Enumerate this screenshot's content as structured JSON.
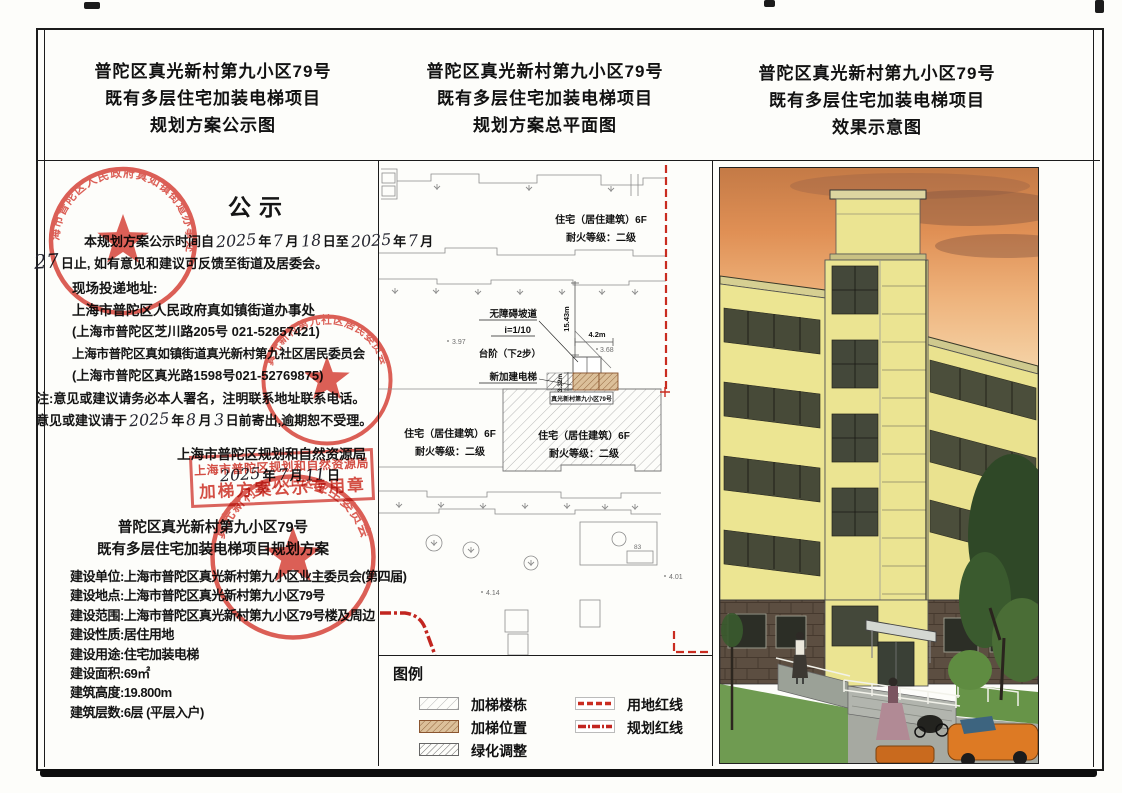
{
  "titles": {
    "left_line1": "普陀区真光新村第九小区79号",
    "left_line2": "既有多层住宅加装电梯项目",
    "left_line3": "规划方案公示图",
    "mid_line1": "普陀区真光新村第九小区79号",
    "mid_line2": "既有多层住宅加装电梯项目",
    "mid_line3": "规划方案总平面图",
    "right_line1": "普陀区真光新村第九小区79号",
    "right_line2": "既有多层住宅加装电梯项目",
    "right_line3": "效果示意图"
  },
  "notice": {
    "heading": "公示",
    "p1_a": "本规划方案公示时间自",
    "p1_y1": "2025",
    "p1_t1": "年",
    "p1_m1": "7",
    "p1_t2": "月",
    "p1_d1": "18",
    "p1_t3": "日至",
    "p1_y2": "2025",
    "p1_t4": "年",
    "p1_m2": "7",
    "p1_t5": "月",
    "p1_d2": "27",
    "p1_b": "日止, 如有意见和建议可反馈至街道及居委会。",
    "addr_label": "现场投递地址:",
    "addr1": "上海市普陀区人民政府真如镇街道办事处",
    "addr1_detail": "(上海市普陀区芝川路205号 021-52857421)",
    "addr2": "上海市普陀区真如镇街道真光新村第九社区居民委员会",
    "addr2_detail": "(上海市普陀区真光路1598号021-52769875)",
    "note1": "注:意见或建议请务必本人署名，注明联系地址联系电话。",
    "note2_a": "意见或建议请于",
    "note2_y": "2025",
    "note2_t1": "年",
    "note2_m": "8",
    "note2_t2": "月",
    "note2_d": "3",
    "note2_b": "日前寄出,逾期恕不受理。"
  },
  "authority": {
    "name": "上海市普陀区规划和自然资源局",
    "date_y": "2025",
    "date_t1": "年",
    "date_m": "7",
    "date_t2": "月",
    "date_d": "11",
    "date_t3": "日",
    "stamp_line1": "上海市普陀区规划和自然资源局",
    "stamp_line2": "加梯方案公示专用章"
  },
  "project": {
    "name1": "普陀区真光新村第九小区79号",
    "name2": "既有多层住宅加装电梯项目规划方案",
    "details": [
      "建设单位:上海市普陀区真光新村第九小区业主委员会(第四届)",
      "建设地点:上海市普陀区真光新村第九小区79号",
      "建设范围:上海市普陀区真光新村第九小区79号楼及周边",
      "建设性质:居住用地",
      "建设用途:住宅加装电梯",
      "建设面积:69㎡",
      "建筑高度:19.800m",
      "建筑层数:6层 (平层入户)"
    ]
  },
  "stamps": {
    "street_office": "上海市普陀区人民政府真如镇街道办事处",
    "community": "真光新村第九社区居民委员会",
    "owners": "真光新村第九小区业主委员会"
  },
  "siteplan": {
    "bldg_line1": "住宅（居住建筑）6F",
    "bldg_line2": "耐火等级：二级",
    "callout_ramp": "无障碍坡道",
    "callout_ramp2": "i=1/10",
    "callout_steps": "台阶（下2步）",
    "callout_elevator": "新加建电梯",
    "dim_1543": "15.43m",
    "dim_42": "4.2m",
    "dim_332": "3.32m",
    "spot_368": "3.68",
    "spot_397": "3.97",
    "spot_414": "4.14",
    "spot_401": "4.01",
    "num_83": "83",
    "bldg_tag": "真光新村第九小区79号"
  },
  "legend": {
    "title": "图例",
    "item1": "加梯楼栋",
    "item2": "加梯位置",
    "item3": "绿化调整",
    "item4": "用地红线",
    "item5": "规划红线"
  },
  "colors": {
    "stamp_red": "#d0352b",
    "red_line": "#c92c20",
    "facade_yellow": "#ebe492",
    "window_dark": "#474a38"
  }
}
